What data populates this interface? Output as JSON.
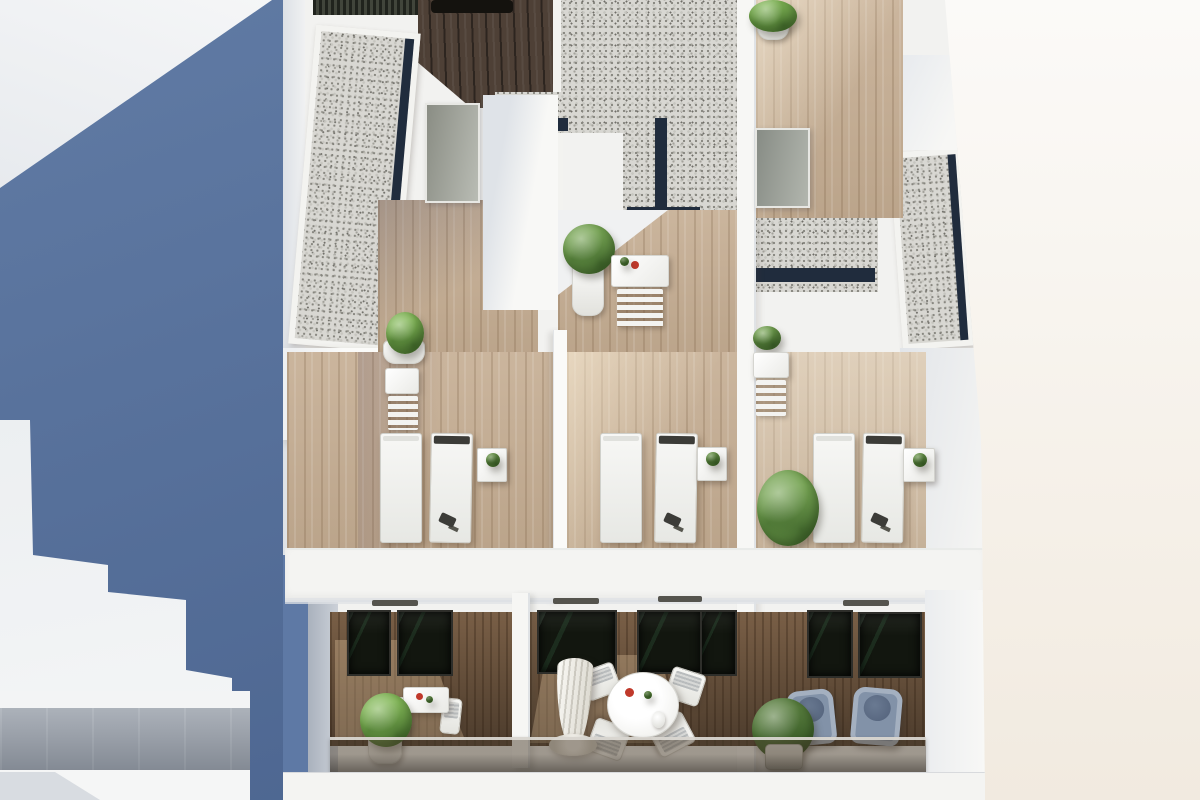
{
  "scene": {
    "type": "architectural_3d_render",
    "view": "aerial_oblique",
    "subject": "Modern white apartment building: stepped gravel roofs, rooftop wooden terraces with sun loungers, and lower balconies with outdoor furniture",
    "lighting": "bright sunlight from upper-left casting blue-grey shadows",
    "people_visible": 0,
    "text_visible": ""
  },
  "palette": {
    "sky_shadow_blue": "#57739f",
    "gap_shadow_blue": "#5e79a5",
    "wall_white": "#f2f2f0",
    "wall_shadow": "#d9dde2",
    "background_right": "#f7f4ef",
    "gravel_base": "#d8d7d2",
    "navy_edge": "#202c3d",
    "dark_deck_wood": "#4e4036",
    "terrace_wood": "#c5ad92",
    "terrace_wood_sun": "#e3cfae",
    "balcony_wood": "#8a6c50",
    "window_dark": "#12160f",
    "glass_tint": "#2c241a",
    "plant_green": "#76a453",
    "plant_green_dark": "#587d3e",
    "pot_white": "#fbfbf9",
    "lounger_white": "#f2f3f1",
    "armchair_grey_blue": "#8292a8",
    "umbrella_white": "#efede7",
    "table_accent_red": "#c0392b",
    "neighbor_glass_grey": "#9aa1ab"
  },
  "inventory": {
    "gravel_roof_sections": 3,
    "dark_wood_roof_deck": 1,
    "rooftop_terraces": 3,
    "sun_loungers": 6,
    "lounger_side_tables": 3,
    "rooftop_bistro_sets": 3,
    "potted_plants": 10,
    "balconies": 3,
    "balcony_round_dining_set_chairs": 4,
    "balcony_square_table_chairs": 2,
    "armchairs": 2,
    "closed_parasol": 1,
    "dark_glass_door_panes": 7,
    "ac_vent_slots": 4,
    "glass_balustrade": 1
  }
}
